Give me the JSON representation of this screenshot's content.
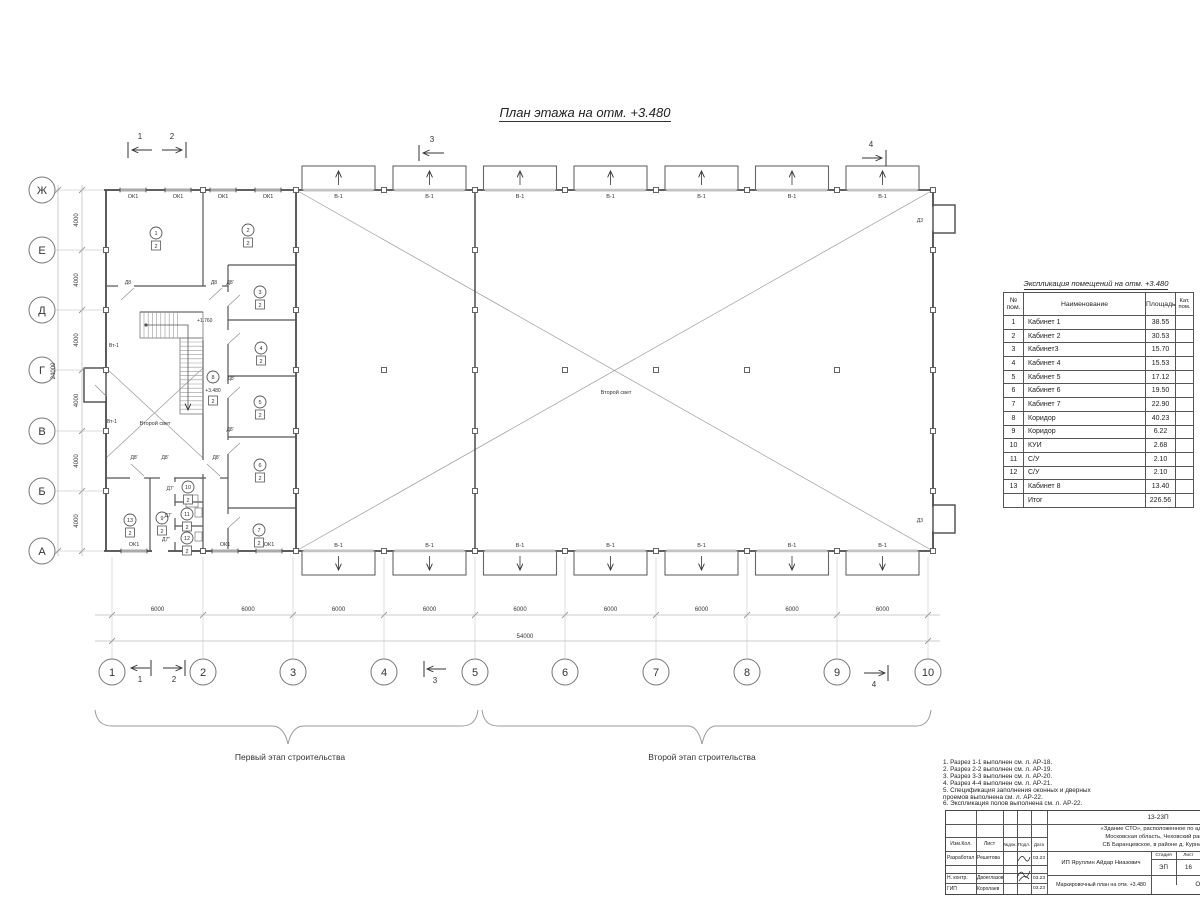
{
  "title": "План этажа на отм. +3.480",
  "plan": {
    "axes": {
      "cols": [
        "1",
        "2",
        "3",
        "4",
        "5",
        "6",
        "7",
        "8",
        "9",
        "10"
      ],
      "rows": [
        "Ж",
        "Е",
        "Д",
        "Г",
        "В",
        "Б",
        "А"
      ],
      "col_spacing": "6000",
      "col_total": "54000",
      "row_spacing": "4000",
      "row_total": "24000"
    },
    "section_marks": [
      "1",
      "2",
      "3",
      "4"
    ],
    "marks": {
      "window": "ОК1",
      "gate": "В-1",
      "door_exit": "Д3",
      "door_d8": "Д8",
      "door_d8a": "Д8'",
      "door_d7a": "Д7'",
      "door_d7b": "Д7''",
      "vent": "Вт-1",
      "void_label": "Второй свет",
      "stair_level": "+1.760",
      "floor_level": "+3.480",
      "category": "2"
    },
    "rooms": [
      {
        "num": "1",
        "cat": "2"
      },
      {
        "num": "2",
        "cat": "2"
      },
      {
        "num": "3",
        "cat": "2"
      },
      {
        "num": "4",
        "cat": "2"
      },
      {
        "num": "5",
        "cat": "2"
      },
      {
        "num": "6",
        "cat": "2"
      },
      {
        "num": "7",
        "cat": "2"
      },
      {
        "num": "8",
        "cat": "2"
      },
      {
        "num": "9",
        "cat": "2"
      },
      {
        "num": "10",
        "cat": "2"
      },
      {
        "num": "11",
        "cat": "2"
      },
      {
        "num": "12",
        "cat": "2"
      },
      {
        "num": "13",
        "cat": "2"
      }
    ],
    "stage1_label": "Первый этап строительства",
    "stage2_label": "Второй этап строительства"
  },
  "schedule": {
    "title": "Экспликация помещений на отм. +3.480",
    "headers": [
      "№ пом.",
      "Наименование",
      "Площадь",
      "Кат. пом."
    ],
    "rows": [
      [
        "1",
        "Кабинет 1",
        "38.55",
        ""
      ],
      [
        "2",
        "Кабинет 2",
        "30.53",
        ""
      ],
      [
        "3",
        "Кабинет3",
        "15.70",
        ""
      ],
      [
        "4",
        "Кабинет 4",
        "15.53",
        ""
      ],
      [
        "5",
        "Кабинет 5",
        "17.12",
        ""
      ],
      [
        "6",
        "Кабинет 6",
        "19.50",
        ""
      ],
      [
        "7",
        "Кабинет 7",
        "22.90",
        ""
      ],
      [
        "8",
        "Коридор",
        "40.23",
        ""
      ],
      [
        "9",
        "Коридор",
        "6.22",
        ""
      ],
      [
        "10",
        "КУИ",
        "2.68",
        ""
      ],
      [
        "11",
        "С/У",
        "2.10",
        ""
      ],
      [
        "12",
        "С/У",
        "2.10",
        ""
      ],
      [
        "13",
        "Кабинет 8",
        "13.40",
        ""
      ],
      [
        "",
        "Итог",
        "226.56",
        ""
      ]
    ]
  },
  "notes": [
    "1. Разрез 1-1 выполнен см. л. АР-18.",
    "2. Разрез 2-2 выполнен см. л. АР-19.",
    "3. Разрез 3-3 выполнен см. л. АР-20.",
    "4. Разрез 4-4 выполнен см. л. АР-21.",
    "5. Спецификация заполнения оконных и дверных",
    "    проемов выполнена см. л. АР-22.",
    "6. Экспликация полов выполнена см. л. АР-22."
  ],
  "titleblock": {
    "doc_number": "13-23П",
    "address_lines": [
      "«Здание СТО», расположенное по адресу:",
      "Московская область, Чеховский район,",
      "СБ Баранцевское, в районе д. Курниково"
    ],
    "cols": [
      "Изм.Кол.",
      "Лист",
      "№док.",
      "Подл.",
      "Дата"
    ],
    "rows": [
      {
        "role": "Разработал",
        "name": "Решетова",
        "date": "03.23"
      },
      {
        "role": "Н. контр.",
        "name": "Двоеглазов",
        "date": "03.23"
      },
      {
        "role": "ГИП",
        "name": "Королаев",
        "date": "03.23"
      }
    ],
    "client": "ИП Яруллин Айдар Ниазович",
    "stage_label": "Стадия",
    "sheet_label": "Лист",
    "stage": "ЭП",
    "sheet": "16",
    "drawing_title": "Маркировочный план на отм. +3.480",
    "company": "ООО \"Аль"
  }
}
